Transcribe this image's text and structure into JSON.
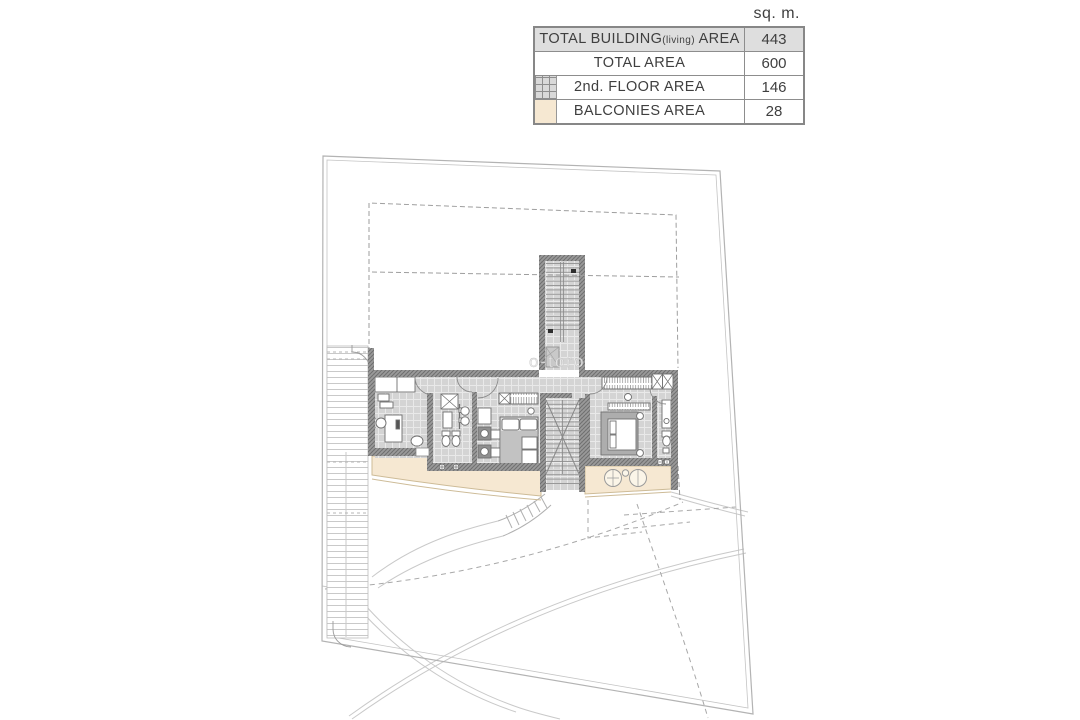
{
  "area_table": {
    "unit_header": "sq. m.",
    "rows": [
      {
        "label_main": "TOTAL BUILDING",
        "label_small": "(living)",
        "label_tail": " AREA",
        "value": "443"
      },
      {
        "label_main": "TOTAL AREA",
        "value": "600"
      },
      {
        "label_main": "2nd. FLOOR AREA",
        "value": "146"
      },
      {
        "label_main": "BALCONIES AREA",
        "value": "28"
      }
    ]
  },
  "watermark": "o-toro",
  "colors": {
    "balcony_fill": "#f6e8d2",
    "balcony_border": "#cdbb97",
    "floor_tile": "#d4d4d4",
    "wall": "#8f8f8f",
    "boundary_line": "#b5b5b5",
    "table_shaded_row": "#dedede"
  }
}
